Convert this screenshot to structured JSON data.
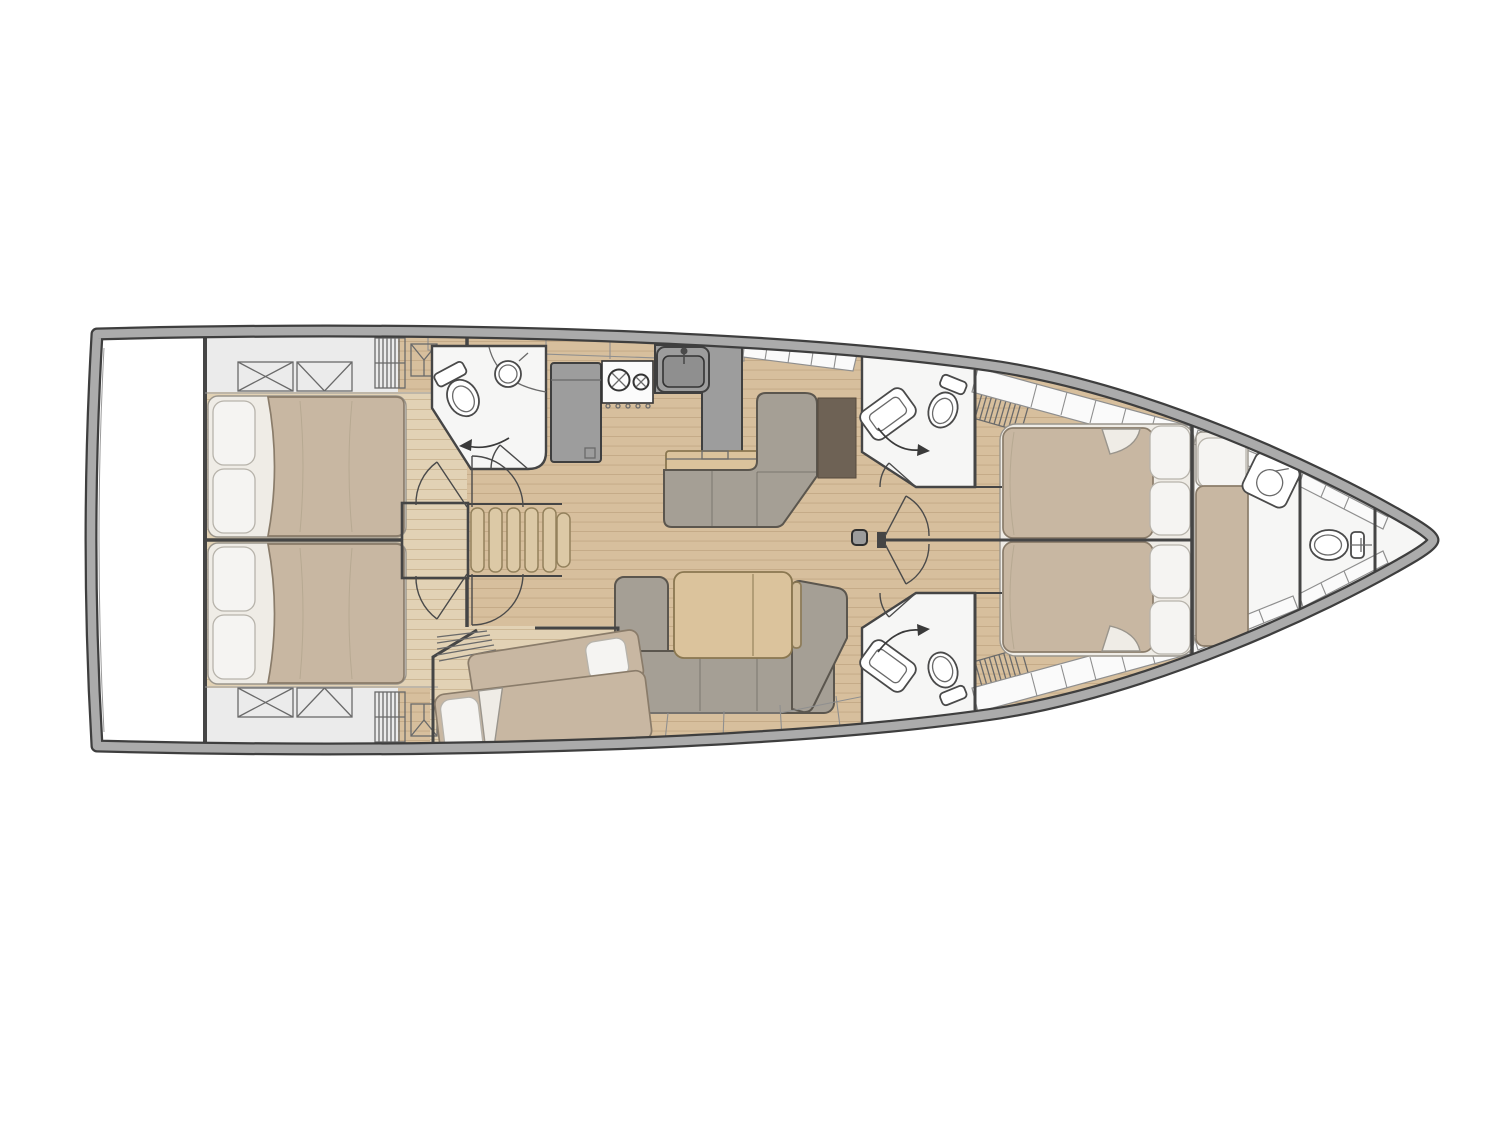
{
  "figure": {
    "kind": "yacht-interior-floor-plan",
    "orientation": "bow-right",
    "visible_text": ""
  },
  "colors": {
    "background": "#ffffff",
    "hull_band": "#ababab",
    "hull_line": "#3e3e3e",
    "deck": "#ebebeb",
    "platform": "#ffffff",
    "wood": "#d7bf9d",
    "wood_line": "#c3a985",
    "cabin_floor": "#e2d2b5",
    "cabin_floor_line": "#cdb896",
    "bed": "#c8b7a2",
    "bed_line": "#8a7c6a",
    "bed_fold": "#b7a992",
    "sheet": "#efece6",
    "sheet_line": "#9a958c",
    "pillow": "#f5f4f2",
    "pillow_line": "#b7b3ab",
    "sofa": "#a59f95",
    "sofa_line": "#5b564e",
    "table": "#dbc39c",
    "table_line": "#8a7750",
    "stairs": "#dcc9a6",
    "stairs_line": "#93815c",
    "counter": "#9d9d9d",
    "counter_line": "#3f3f3f",
    "appliance": "#fbfbfb",
    "appliance_line": "#333333",
    "basin": "#8f8f8f",
    "room": "#f6f6f5",
    "wall": "#454545",
    "fixture": "#ffffff",
    "fixture_line": "#4a4a4a",
    "panel": "#6e6255",
    "panel_line": "#564a3d",
    "lining": "#fafafa",
    "lining_line": "#8f8f8f",
    "hatch_line": "#6a6a6a",
    "divider": "#9b9b9b",
    "arrow": "#3a3a3a",
    "mast_fill": "#9c9c9c",
    "mast_line": "#2f2f2f"
  },
  "legend": {
    "areas": [
      {
        "id": "swim-platform"
      },
      {
        "id": "aft-cabin-port"
      },
      {
        "id": "aft-cabin-starboard"
      },
      {
        "id": "aft-head"
      },
      {
        "id": "companionway-stairs"
      },
      {
        "id": "galley"
      },
      {
        "id": "salon"
      },
      {
        "id": "midship-bunk-cabin"
      },
      {
        "id": "forward-head-port"
      },
      {
        "id": "forward-head-starboard"
      },
      {
        "id": "forward-master-cabin"
      },
      {
        "id": "crew-cabin"
      },
      {
        "id": "bow-head"
      },
      {
        "id": "forepeak"
      }
    ],
    "fixtures": [
      {
        "id": "toilet-icon",
        "count": 4
      },
      {
        "id": "sink-icon",
        "count": 5
      },
      {
        "id": "stove-icon",
        "count": 1
      },
      {
        "id": "fridge-icon",
        "count": 1
      },
      {
        "id": "bed-double-icon",
        "count": 4
      },
      {
        "id": "bed-single-icon",
        "count": 3
      },
      {
        "id": "deck-hatch-icon",
        "count": 4
      },
      {
        "id": "louver-locker-icon",
        "count": 4
      },
      {
        "id": "mast-post-icon",
        "count": 1
      }
    ]
  }
}
